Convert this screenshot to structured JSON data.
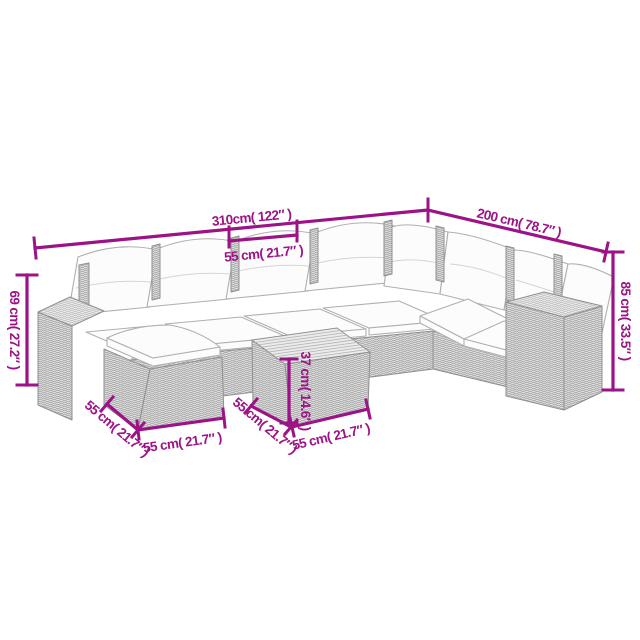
{
  "diagram": {
    "background_color": "#ffffff",
    "accent_color": "#9C1387",
    "pieces": [
      "corner-sofa-with-cushions",
      "left-armrest-module",
      "right-armrest-module",
      "footstool-with-cushion",
      "square-side-table"
    ],
    "labels": {
      "overall_width": "310cm( 122″ )",
      "seat_width": "55 cm( 21.7″ )",
      "overall_depth": "200 cm( 78.7″ )",
      "overall_height": "85 cm( 33.5″ )",
      "armrest_height": "69 cm( 27.2″ )",
      "table_height": "37 cm( 14.6″ )",
      "stool_side": "55 cm( 21.7″ )",
      "stool_front": "55 cm( 21.7″ )",
      "table_side": "55 cm( 21.7″ )",
      "table_front": "55 cm( 21.7″ )"
    }
  }
}
